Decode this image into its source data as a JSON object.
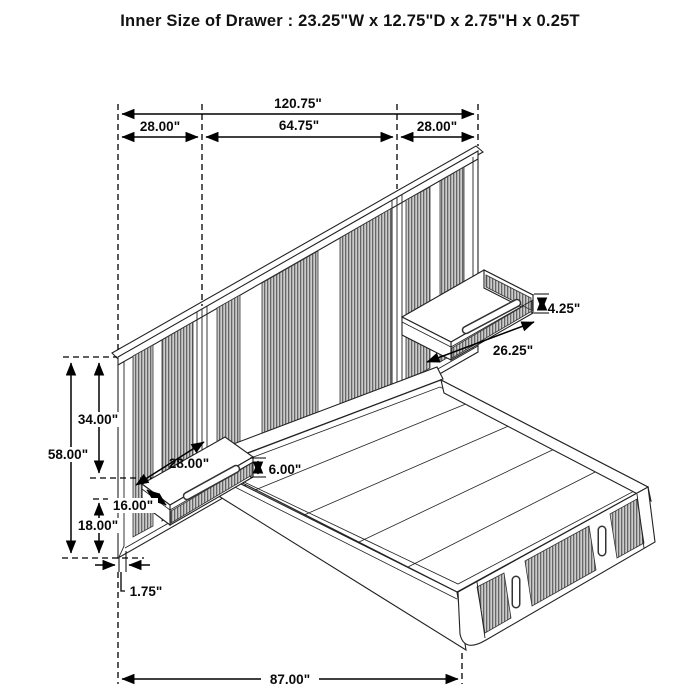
{
  "title": "Inner Size of Drawer : 23.25\"W x 12.75\"D x 2.75\"H x 0.25T",
  "diagram_subject": "wall-bed with panel headboard, floating nightstands and footboard storage drawers",
  "colors": {
    "line": "#000000",
    "hatch_dark": "#666666",
    "hatch_light": "#cccccc",
    "background": "#ffffff"
  },
  "dims": {
    "total_width": "120.75\"",
    "left_section_width": "28.00\"",
    "center_section_width": "64.75\"",
    "right_section_width": "28.00\"",
    "headboard_height": "58.00\"",
    "top_to_nightstand": "34.00\"",
    "nightstand_bottom_to_floor": "18.00\"",
    "nightstand_depth": "16.00\"",
    "left_nightstand_width": "28.00\"",
    "left_nightstand_height": "6.00\"",
    "headboard_thickness": "1.75\"",
    "right_nightstand_height": "4.25\"",
    "right_nightstand_width": "26.25\"",
    "bed_length": "87.00\""
  }
}
